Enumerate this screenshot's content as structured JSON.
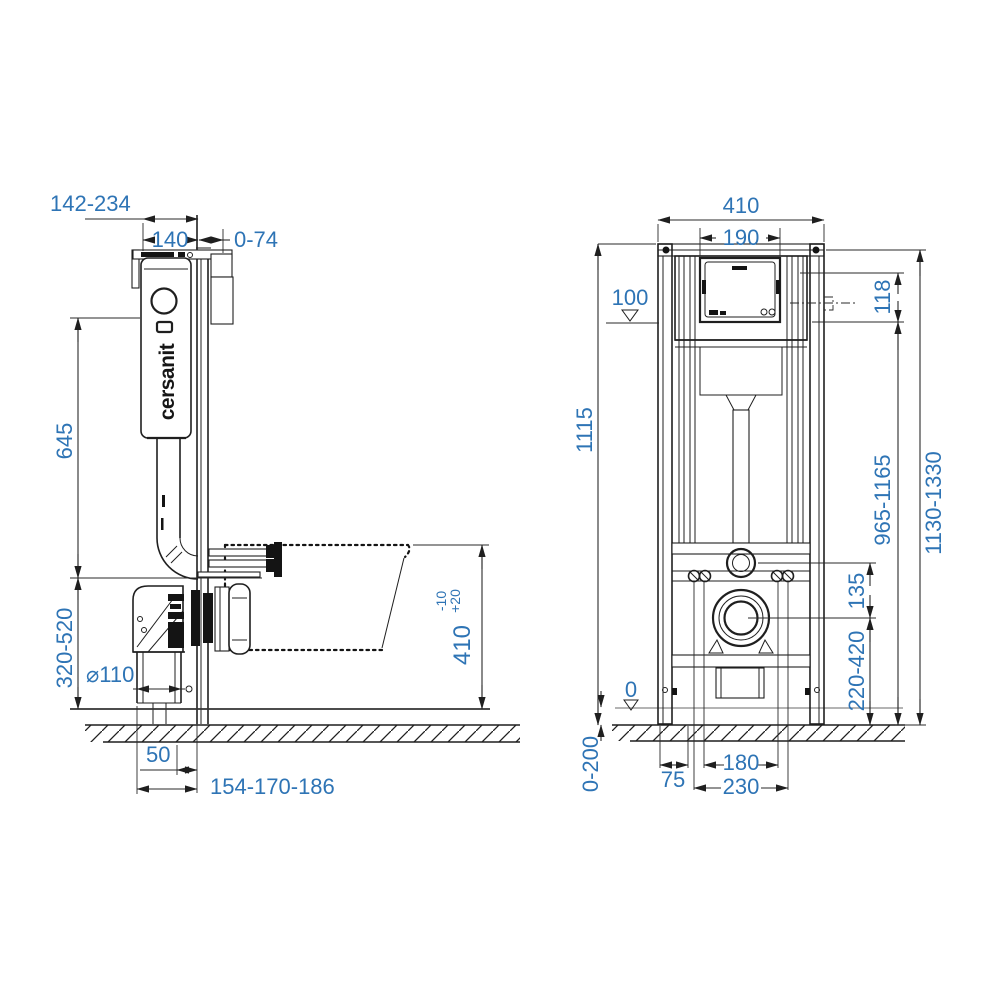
{
  "drawing": {
    "brand_logo": "cersanit",
    "colors": {
      "dimension_text": "#2E74B5",
      "drawing_line": "#1f1f1f",
      "level_line": "#9c9c9c"
    },
    "side_view": {
      "dims": {
        "depth_total": "142-234",
        "cistern_depth": "140",
        "wall_gap": "0-74",
        "cistern_height": "645",
        "outlet_height": "320-520",
        "drain_diameter": "⌀110",
        "drain_offset": "50",
        "frame_depth_range": "154-170-186",
        "bowl_height": "410",
        "bowl_height_plus": "+20",
        "bowl_height_minus": "-10"
      }
    },
    "front_view": {
      "dims": {
        "frame_width": "410",
        "panel_width": "190",
        "plate_marker": "100",
        "panel_height": "118",
        "frame_height": "1115",
        "plate_height_range": "965-1165",
        "total_height_range": "1130-1330",
        "inlet_drain_gap": "135",
        "drain_height_range": "220-420",
        "zero_level": "0",
        "floor_range": "0-200",
        "edge_to_bolt": "75",
        "bolt_spacing_inner": "180",
        "bolt_spacing_outer": "230"
      }
    }
  }
}
